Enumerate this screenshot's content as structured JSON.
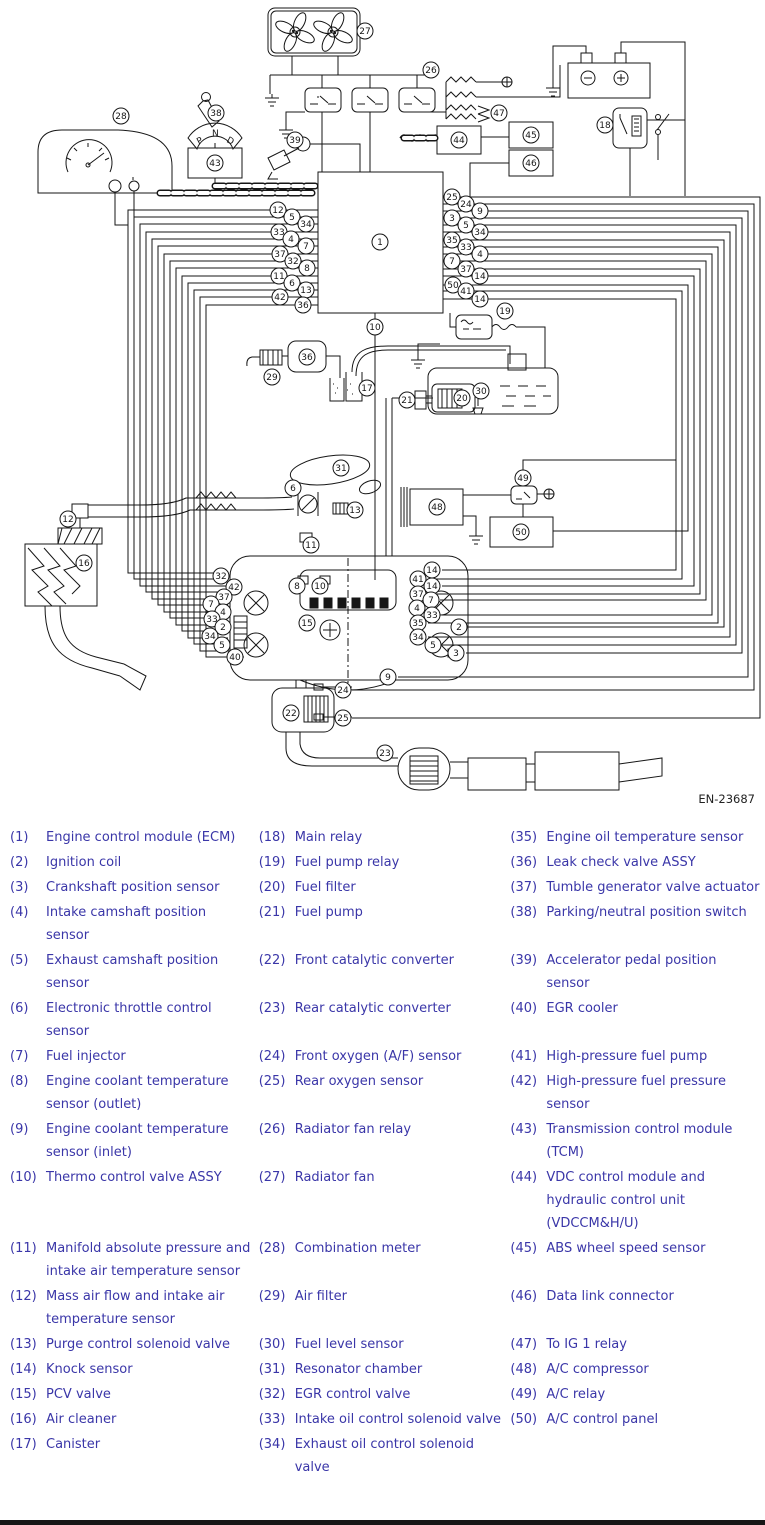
{
  "diagram": {
    "figure_id": "EN-23687",
    "line_color": "#161616",
    "callouts": [
      {
        "n": "27",
        "x": 365,
        "y": 31
      },
      {
        "n": "26",
        "x": 431,
        "y": 70
      },
      {
        "n": "47",
        "x": 499,
        "y": 113
      },
      {
        "n": "18",
        "x": 605,
        "y": 125
      },
      {
        "n": "28",
        "x": 121,
        "y": 116
      },
      {
        "n": "38",
        "x": 216,
        "y": 113
      },
      {
        "n": "43",
        "x": 215,
        "y": 163
      },
      {
        "n": "39",
        "x": 295,
        "y": 140
      },
      {
        "n": "44",
        "x": 459,
        "y": 140
      },
      {
        "n": "45",
        "x": 531,
        "y": 135
      },
      {
        "n": "46",
        "x": 531,
        "y": 163
      },
      {
        "n": "1",
        "x": 380,
        "y": 242
      },
      {
        "n": "10",
        "x": 375,
        "y": 327
      },
      {
        "n": "19",
        "x": 505,
        "y": 311
      },
      {
        "n": "12",
        "x": 278,
        "y": 210
      },
      {
        "n": "5",
        "x": 292,
        "y": 217
      },
      {
        "n": "34",
        "x": 306,
        "y": 224
      },
      {
        "n": "33",
        "x": 279,
        "y": 232
      },
      {
        "n": "4",
        "x": 291,
        "y": 239
      },
      {
        "n": "7",
        "x": 306,
        "y": 246
      },
      {
        "n": "37",
        "x": 280,
        "y": 254
      },
      {
        "n": "32",
        "x": 293,
        "y": 261
      },
      {
        "n": "8",
        "x": 307,
        "y": 268
      },
      {
        "n": "11",
        "x": 279,
        "y": 276
      },
      {
        "n": "6",
        "x": 292,
        "y": 283
      },
      {
        "n": "13",
        "x": 306,
        "y": 290
      },
      {
        "n": "42",
        "x": 280,
        "y": 297
      },
      {
        "n": "36",
        "x": 303,
        "y": 305
      },
      {
        "n": "25",
        "x": 452,
        "y": 197
      },
      {
        "n": "24",
        "x": 466,
        "y": 204
      },
      {
        "n": "9",
        "x": 480,
        "y": 211
      },
      {
        "n": "3",
        "x": 452,
        "y": 218
      },
      {
        "n": "5",
        "x": 466,
        "y": 225
      },
      {
        "n": "34",
        "x": 480,
        "y": 232
      },
      {
        "n": "35",
        "x": 452,
        "y": 240
      },
      {
        "n": "33",
        "x": 466,
        "y": 247
      },
      {
        "n": "4",
        "x": 480,
        "y": 254
      },
      {
        "n": "7",
        "x": 452,
        "y": 261
      },
      {
        "n": "37",
        "x": 466,
        "y": 269
      },
      {
        "n": "14",
        "x": 480,
        "y": 276
      },
      {
        "n": "50",
        "x": 453,
        "y": 285
      },
      {
        "n": "41",
        "x": 466,
        "y": 291
      },
      {
        "n": "14",
        "x": 480,
        "y": 299
      },
      {
        "n": "36",
        "x": 307,
        "y": 357
      },
      {
        "n": "29",
        "x": 272,
        "y": 377
      },
      {
        "n": "17",
        "x": 367,
        "y": 388
      },
      {
        "n": "21",
        "x": 407,
        "y": 400
      },
      {
        "n": "20",
        "x": 462,
        "y": 398
      },
      {
        "n": "30",
        "x": 481,
        "y": 391
      },
      {
        "n": "49",
        "x": 523,
        "y": 478
      },
      {
        "n": "48",
        "x": 437,
        "y": 507
      },
      {
        "n": "50",
        "x": 521,
        "y": 532
      },
      {
        "n": "31",
        "x": 341,
        "y": 468
      },
      {
        "n": "6",
        "x": 293,
        "y": 488
      },
      {
        "n": "13",
        "x": 355,
        "y": 510
      },
      {
        "n": "12",
        "x": 68,
        "y": 519
      },
      {
        "n": "16",
        "x": 84,
        "y": 563
      },
      {
        "n": "11",
        "x": 311,
        "y": 545
      },
      {
        "n": "32",
        "x": 221,
        "y": 576
      },
      {
        "n": "42",
        "x": 234,
        "y": 587
      },
      {
        "n": "37",
        "x": 224,
        "y": 597
      },
      {
        "n": "7",
        "x": 211,
        "y": 604
      },
      {
        "n": "4",
        "x": 223,
        "y": 612
      },
      {
        "n": "33",
        "x": 212,
        "y": 619
      },
      {
        "n": "2",
        "x": 223,
        "y": 627
      },
      {
        "n": "34",
        "x": 210,
        "y": 636
      },
      {
        "n": "5",
        "x": 222,
        "y": 645
      },
      {
        "n": "40",
        "x": 235,
        "y": 657
      },
      {
        "n": "8",
        "x": 297,
        "y": 586
      },
      {
        "n": "10",
        "x": 320,
        "y": 586
      },
      {
        "n": "15",
        "x": 307,
        "y": 623
      },
      {
        "n": "14",
        "x": 432,
        "y": 570
      },
      {
        "n": "41",
        "x": 418,
        "y": 579
      },
      {
        "n": "14",
        "x": 432,
        "y": 586
      },
      {
        "n": "37",
        "x": 418,
        "y": 594
      },
      {
        "n": "7",
        "x": 431,
        "y": 600
      },
      {
        "n": "4",
        "x": 417,
        "y": 608
      },
      {
        "n": "33",
        "x": 432,
        "y": 615
      },
      {
        "n": "35",
        "x": 418,
        "y": 623
      },
      {
        "n": "2",
        "x": 459,
        "y": 627
      },
      {
        "n": "34",
        "x": 418,
        "y": 637
      },
      {
        "n": "5",
        "x": 433,
        "y": 645
      },
      {
        "n": "3",
        "x": 456,
        "y": 653
      },
      {
        "n": "9",
        "x": 388,
        "y": 677
      },
      {
        "n": "24",
        "x": 343,
        "y": 690
      },
      {
        "n": "22",
        "x": 291,
        "y": 713
      },
      {
        "n": "25",
        "x": 343,
        "y": 718
      },
      {
        "n": "23",
        "x": 385,
        "y": 753
      }
    ]
  },
  "legend": {
    "text_color": "#3a36a8",
    "rows": [
      [
        {
          "num": "(1)",
          "label": "Engine control module (ECM)"
        },
        {
          "num": "(18)",
          "label": "Main relay"
        },
        {
          "num": "(35)",
          "label": "Engine oil temperature sensor"
        }
      ],
      [
        {
          "num": "(2)",
          "label": "Ignition coil"
        },
        {
          "num": "(19)",
          "label": "Fuel pump relay"
        },
        {
          "num": "(36)",
          "label": "Leak check valve ASSY"
        }
      ],
      [
        {
          "num": "(3)",
          "label": "Crankshaft position sensor"
        },
        {
          "num": "(20)",
          "label": "Fuel filter"
        },
        {
          "num": "(37)",
          "label": "Tumble generator valve actuator"
        }
      ],
      [
        {
          "num": "(4)",
          "label": "Intake camshaft position sensor"
        },
        {
          "num": "(21)",
          "label": "Fuel pump"
        },
        {
          "num": "(38)",
          "label": "Parking/neutral position switch"
        }
      ],
      [
        {
          "num": "(5)",
          "label": "Exhaust camshaft position sensor"
        },
        {
          "num": "(22)",
          "label": "Front catalytic converter"
        },
        {
          "num": "(39)",
          "label": "Accelerator pedal position sensor"
        }
      ],
      [
        {
          "num": "(6)",
          "label": "Electronic throttle control sensor"
        },
        {
          "num": "(23)",
          "label": "Rear catalytic converter"
        },
        {
          "num": "(40)",
          "label": "EGR cooler"
        }
      ],
      [
        {
          "num": "(7)",
          "label": "Fuel injector"
        },
        {
          "num": "(24)",
          "label": "Front oxygen (A/F) sensor"
        },
        {
          "num": "(41)",
          "label": "High-pressure fuel pump"
        }
      ],
      [
        {
          "num": "(8)",
          "label": "Engine coolant temperature sensor (outlet)"
        },
        {
          "num": "(25)",
          "label": "Rear oxygen sensor"
        },
        {
          "num": "(42)",
          "label": "High-pressure fuel pressure sensor"
        }
      ],
      [
        {
          "num": "(9)",
          "label": "Engine coolant temperature sensor (inlet)"
        },
        {
          "num": "(26)",
          "label": "Radiator fan relay"
        },
        {
          "num": "(43)",
          "label": "Transmission control module (TCM)"
        }
      ],
      [
        {
          "num": "(10)",
          "label": "Thermo control valve ASSY"
        },
        {
          "num": "(27)",
          "label": "Radiator fan"
        },
        {
          "num": "(44)",
          "label": "VDC control module and hydraulic control unit (VDCCM&H/U)"
        }
      ],
      [
        {
          "num": "(11)",
          "label": "Manifold absolute pressure and intake air temperature sensor"
        },
        {
          "num": "(28)",
          "label": "Combination meter"
        },
        {
          "num": "(45)",
          "label": "ABS wheel speed sensor"
        }
      ],
      [
        {
          "num": "(12)",
          "label": "Mass air flow and intake air temperature sensor"
        },
        {
          "num": "(29)",
          "label": "Air filter"
        },
        {
          "num": "(46)",
          "label": "Data link connector"
        }
      ],
      [
        {
          "num": "(13)",
          "label": "Purge control solenoid valve"
        },
        {
          "num": "(30)",
          "label": "Fuel level sensor"
        },
        {
          "num": "(47)",
          "label": "To IG 1 relay"
        }
      ],
      [
        {
          "num": "(14)",
          "label": "Knock sensor"
        },
        {
          "num": "(31)",
          "label": "Resonator chamber"
        },
        {
          "num": "(48)",
          "label": "A/C compressor"
        }
      ],
      [
        {
          "num": "(15)",
          "label": "PCV valve"
        },
        {
          "num": "(32)",
          "label": "EGR control valve"
        },
        {
          "num": "(49)",
          "label": "A/C relay"
        }
      ],
      [
        {
          "num": "(16)",
          "label": "Air cleaner"
        },
        {
          "num": "(33)",
          "label": "Intake oil control solenoid valve"
        },
        {
          "num": "(50)",
          "label": "A/C control panel"
        }
      ],
      [
        {
          "num": "(17)",
          "label": "Canister"
        },
        {
          "num": "(34)",
          "label": "Exhaust oil control solenoid valve"
        },
        null
      ]
    ]
  }
}
